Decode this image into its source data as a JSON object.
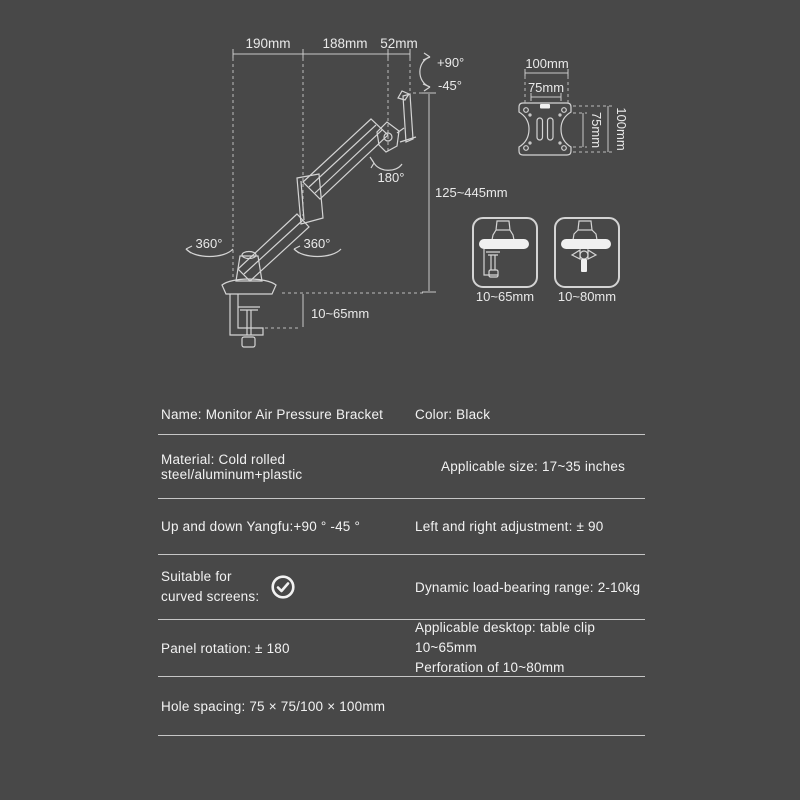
{
  "colors": {
    "background": "#484848",
    "line": "#d4d4d4",
    "text": "#f2f2f2",
    "divider": "#c6c6c6"
  },
  "diagram": {
    "top_dimensions": [
      "190mm",
      "188mm",
      "52mm"
    ],
    "tilt_up": "+90°",
    "tilt_down": "-45°",
    "panel_rotation": "180°",
    "swivel_left": "360°",
    "swivel_right": "360°",
    "height_range": "125~445mm",
    "clamp_range": "10~65mm",
    "vesa": {
      "width_outer": "100mm",
      "width_inner": "75mm",
      "height_inner": "75mm",
      "height_outer": "100mm"
    },
    "mount_options": [
      {
        "type": "table-clamp",
        "label": "10~65mm"
      },
      {
        "type": "grommet",
        "label": "10~80mm"
      }
    ]
  },
  "specs": {
    "rows": [
      {
        "left": "Name: Monitor Air Pressure Bracket",
        "right": "Color: Black"
      },
      {
        "left": "Material: Cold rolled steel/aluminum+plastic",
        "right": "Applicable size: 17~35 inches"
      },
      {
        "left": "Up and down Yangfu:+90 ° -45 °",
        "right": "Left and right adjustment: ± 90"
      },
      {
        "left_line1": "Suitable for",
        "left_line2": "curved screens:",
        "icon": "check-circle",
        "right": "Dynamic load-bearing range: 2-10kg"
      },
      {
        "left": "Panel rotation: ± 180",
        "right_line1": "Applicable desktop: table clip 10~65mm",
        "right_line2": "Perforation of 10~80mm"
      },
      {
        "left": "Hole spacing: 75 × 75/100 × 100mm",
        "right": ""
      }
    ]
  }
}
